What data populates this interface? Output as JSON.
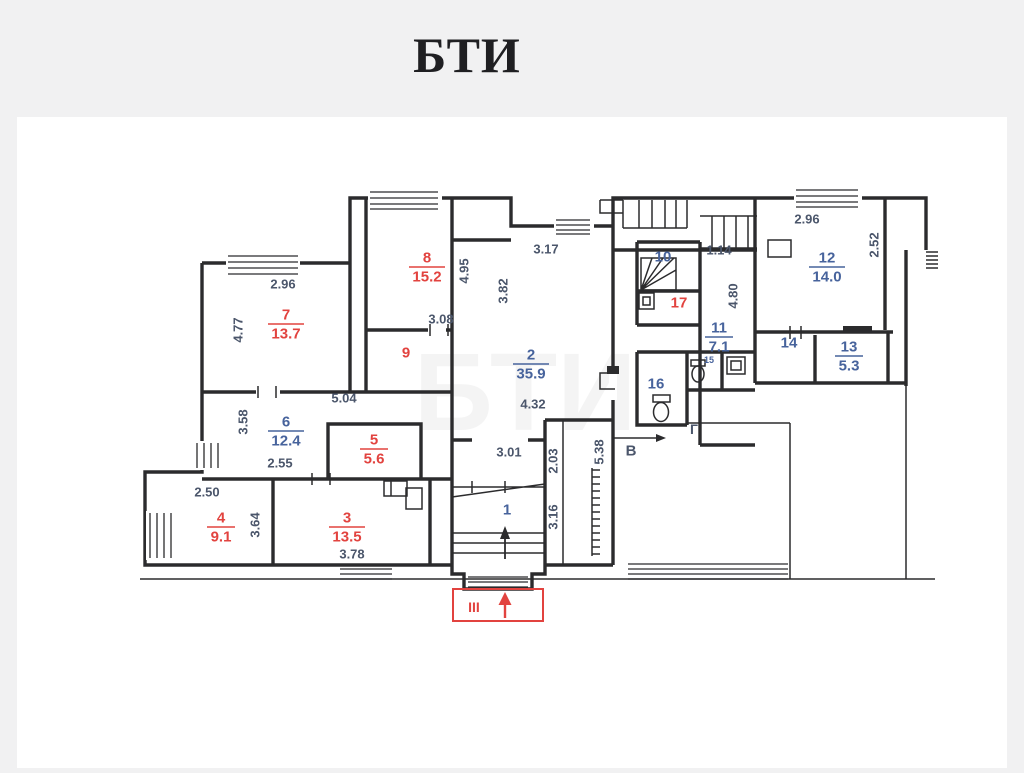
{
  "page": {
    "title": "БТИ"
  },
  "colors": {
    "background": "#f1f1f2",
    "panel": "#ffffff",
    "wall": "#2b2b2d",
    "red": "#e2433f",
    "room_label": "#47639c",
    "dimension": "#4b566b"
  },
  "plan": {
    "rooms": [
      {
        "number": "7",
        "area": "13.7",
        "style": "red",
        "x": 286,
        "y": 323
      },
      {
        "number": "8",
        "area": "15.2",
        "style": "red",
        "x": 427,
        "y": 266
      },
      {
        "number": "2",
        "area": "35.9",
        "style": "blue",
        "x": 531,
        "y": 363
      },
      {
        "number": "6",
        "area": "12.4",
        "style": "blue",
        "x": 286,
        "y": 430
      },
      {
        "number": "5",
        "area": "5.6",
        "style": "red",
        "x": 374,
        "y": 448
      },
      {
        "number": "4",
        "area": "9.1",
        "style": "red",
        "x": 221,
        "y": 526
      },
      {
        "number": "3",
        "area": "13.5",
        "style": "red",
        "x": 347,
        "y": 526
      },
      {
        "number": "11",
        "area": "7.1",
        "style": "blue",
        "x": 719,
        "y": 336
      },
      {
        "number": "12",
        "area": "14.0",
        "style": "blue",
        "x": 827,
        "y": 266
      },
      {
        "number": "13",
        "area": "5.3",
        "style": "blue",
        "x": 849,
        "y": 355
      }
    ],
    "numbers": [
      {
        "number": "1",
        "style": "blue",
        "x": 507,
        "y": 510,
        "size": 15
      },
      {
        "number": "9",
        "style": "red",
        "x": 406,
        "y": 353,
        "size": 15
      },
      {
        "number": "10",
        "style": "blue",
        "x": 663,
        "y": 257,
        "size": 15
      },
      {
        "number": "14",
        "style": "blue",
        "x": 789,
        "y": 343,
        "size": 15
      },
      {
        "number": "15",
        "style": "blue",
        "x": 709,
        "y": 360,
        "size": 9
      },
      {
        "number": "16",
        "style": "blue",
        "x": 656,
        "y": 384,
        "size": 15
      },
      {
        "number": "17",
        "style": "red",
        "x": 679,
        "y": 303,
        "size": 15
      }
    ],
    "dimensions": [
      {
        "value": "2.96",
        "x": 283,
        "y": 284,
        "rotate": 0
      },
      {
        "value": "4.77",
        "x": 238,
        "y": 330,
        "rotate": -90
      },
      {
        "value": "4.95",
        "x": 464,
        "y": 271,
        "rotate": -90
      },
      {
        "value": "3.08",
        "x": 441,
        "y": 319,
        "rotate": 0
      },
      {
        "value": "3.17",
        "x": 546,
        "y": 249,
        "rotate": 0
      },
      {
        "value": "3.82",
        "x": 503,
        "y": 291,
        "rotate": -90
      },
      {
        "value": "1.14",
        "x": 719,
        "y": 250,
        "rotate": 0
      },
      {
        "value": "4.80",
        "x": 733,
        "y": 296,
        "rotate": -90
      },
      {
        "value": "2.96",
        "x": 807,
        "y": 219,
        "rotate": 0
      },
      {
        "value": "2.52",
        "x": 874,
        "y": 245,
        "rotate": -90
      },
      {
        "value": "5.04",
        "x": 344,
        "y": 398,
        "rotate": 0
      },
      {
        "value": "3.58",
        "x": 243,
        "y": 422,
        "rotate": -90
      },
      {
        "value": "2.55",
        "x": 280,
        "y": 463,
        "rotate": 0
      },
      {
        "value": "2.50",
        "x": 207,
        "y": 492,
        "rotate": 0
      },
      {
        "value": "3.64",
        "x": 255,
        "y": 525,
        "rotate": -90
      },
      {
        "value": "3.78",
        "x": 352,
        "y": 554,
        "rotate": 0
      },
      {
        "value": "4.32",
        "x": 533,
        "y": 404,
        "rotate": 0
      },
      {
        "value": "3.01",
        "x": 509,
        "y": 452,
        "rotate": 0
      },
      {
        "value": "2.03",
        "x": 553,
        "y": 461,
        "rotate": -90
      },
      {
        "value": "3.16",
        "x": 553,
        "y": 517,
        "rotate": -90
      },
      {
        "value": "5.38",
        "x": 599,
        "y": 452,
        "rotate": -90
      }
    ],
    "markers": [
      {
        "text": "В",
        "x": 631,
        "y": 451,
        "style": "dim",
        "size": 15
      },
      {
        "text": "Г",
        "x": 694,
        "y": 429,
        "style": "dim",
        "size": 14
      },
      {
        "text": "III",
        "x": 474,
        "y": 607,
        "style": "red",
        "size": 14
      }
    ],
    "watermark": "БТИ"
  }
}
